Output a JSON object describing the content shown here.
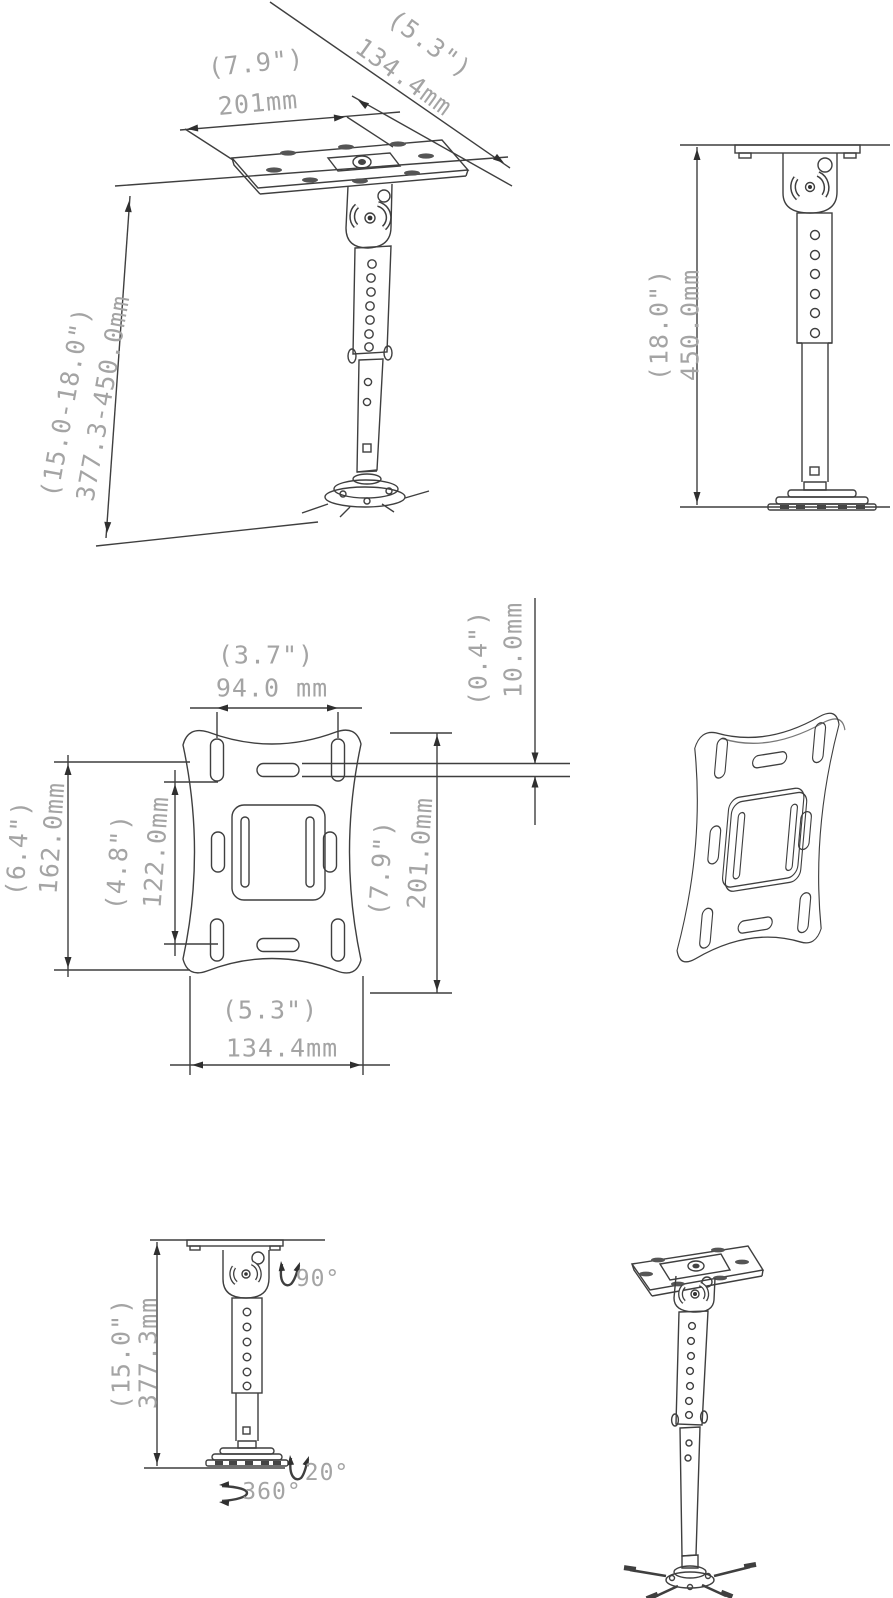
{
  "meta": {
    "title": "Adjustable projector ceiling mount - dimensional drawing"
  },
  "colors": {
    "line": "#3f3f3f",
    "dim_text": "#a4a4a4",
    "background": "#ffffff"
  },
  "iso_extended": {
    "width_in": "(7.9\")",
    "width_mm": "201mm",
    "depth_in": "(5.3\")",
    "depth_mm": "134.4mm",
    "height_in": "(15.0-18.0\")",
    "height_mm": "377.3-450.0mm"
  },
  "front_extended": {
    "height_in": "(18.0\")",
    "height_mm": "450.0mm"
  },
  "plate_front": {
    "top_span_in": "(3.7\")",
    "top_span_mm": "94.0 mm",
    "slot_in": "(0.4\")",
    "slot_mm": "10.0mm",
    "left_outer_in": "(6.4\")",
    "left_outer_mm": "162.0mm",
    "left_inner_in": "(4.8\")",
    "left_inner_mm": "122.0mm",
    "right_in": "(7.9\")",
    "right_mm": "201.0mm",
    "bottom_in": "(5.3\")",
    "bottom_mm": "134.4mm"
  },
  "front_retracted": {
    "height_in": "(15.0\")",
    "height_mm": "377.3mm",
    "tilt_top": "90°",
    "tilt_bottom": "20°",
    "swivel": "360°"
  }
}
